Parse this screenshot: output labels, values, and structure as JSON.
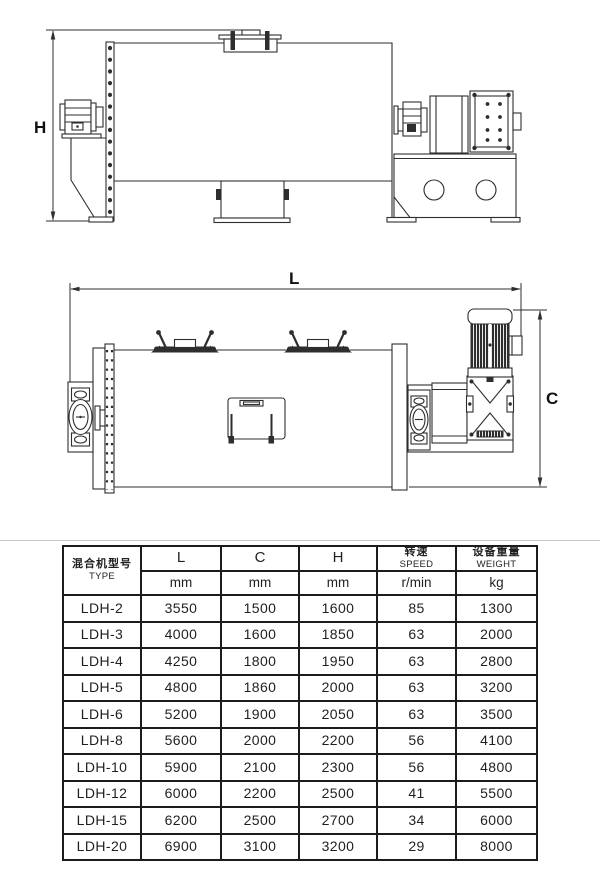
{
  "page": {
    "background": "#ffffff"
  },
  "diagrams": {
    "labels": {
      "h": "H",
      "l": "L",
      "c": "C"
    }
  },
  "table": {
    "headers": {
      "type_zh": "混合机型号",
      "type_en": "TYPE",
      "col_l": "L",
      "col_c": "C",
      "col_h": "H",
      "speed_zh": "转速",
      "speed_en": "SPEED",
      "weight_zh": "设备重量",
      "weight_en": "WEIGHT"
    },
    "units": [
      "mm",
      "mm",
      "mm",
      "r/min",
      "kg"
    ],
    "rows": [
      [
        "LDH-2",
        "3550",
        "1500",
        "1600",
        "85",
        "1300"
      ],
      [
        "LDH-3",
        "4000",
        "1600",
        "1850",
        "63",
        "2000"
      ],
      [
        "LDH-4",
        "4250",
        "1800",
        "1950",
        "63",
        "2800"
      ],
      [
        "LDH-5",
        "4800",
        "1860",
        "2000",
        "63",
        "3200"
      ],
      [
        "LDH-6",
        "5200",
        "1900",
        "2050",
        "63",
        "3500"
      ],
      [
        "LDH-8",
        "5600",
        "2000",
        "2200",
        "56",
        "4100"
      ],
      [
        "LDH-10",
        "5900",
        "2100",
        "2300",
        "56",
        "4800"
      ],
      [
        "LDH-12",
        "6000",
        "2200",
        "2500",
        "41",
        "5500"
      ],
      [
        "LDH-15",
        "6200",
        "2500",
        "2700",
        "34",
        "6000"
      ],
      [
        "LDH-20",
        "6900",
        "3100",
        "3200",
        "29",
        "8000"
      ]
    ]
  },
  "colors": {
    "line": "#2e2e2e",
    "table_border": "#1c1c1c",
    "divider_rule": "#c9c9c9",
    "text": "#1f1f1f",
    "background": "#ffffff"
  }
}
